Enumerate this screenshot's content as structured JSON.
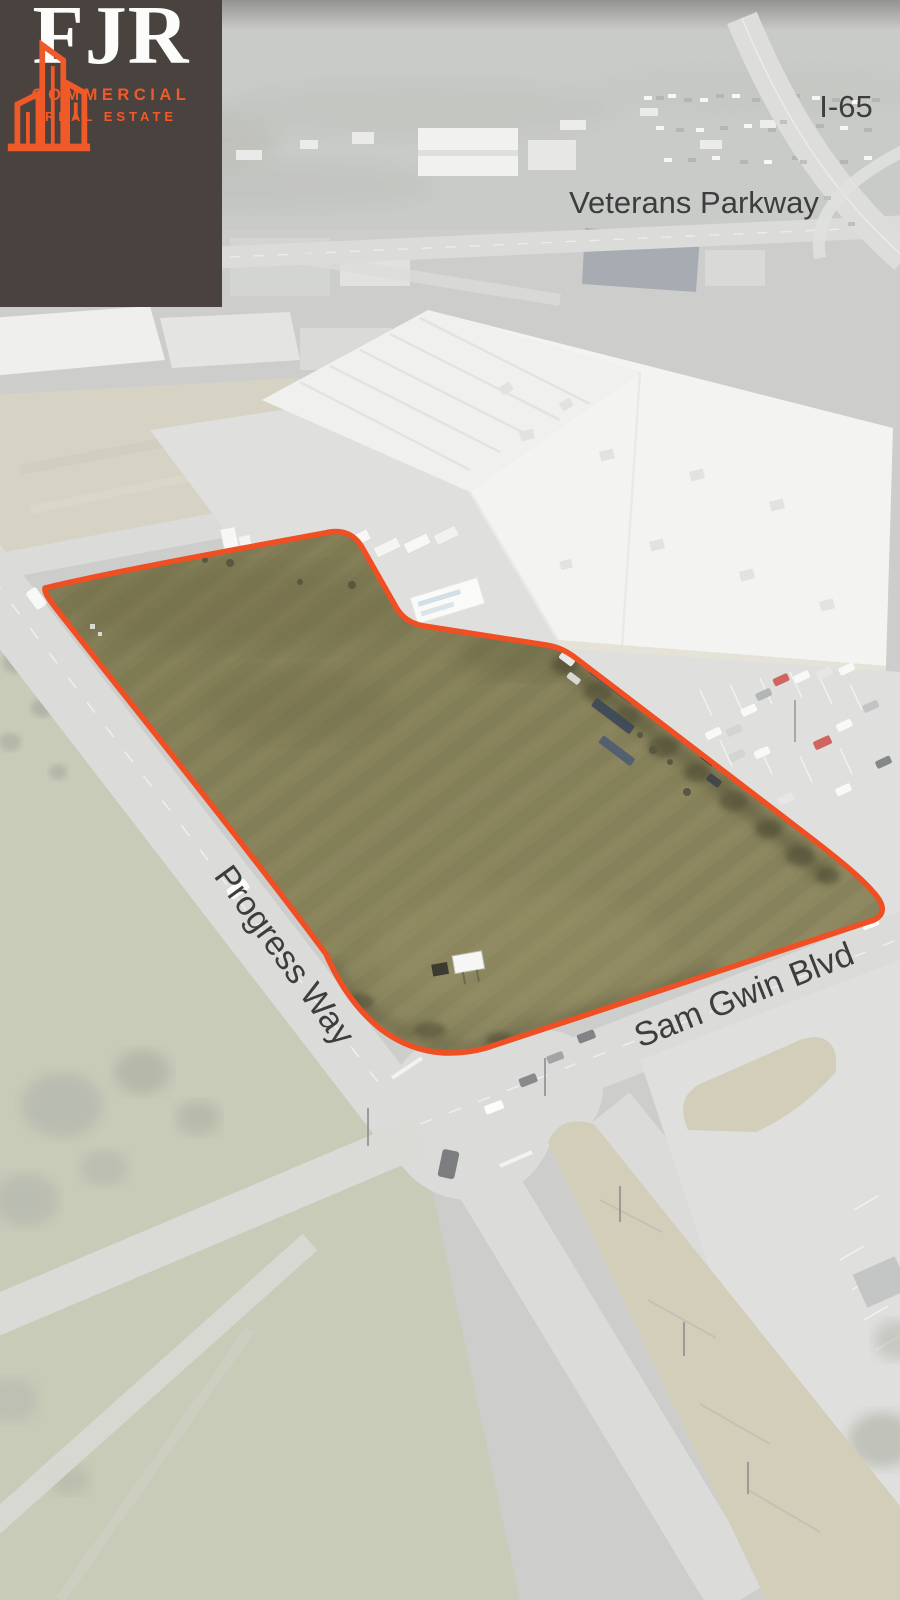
{
  "brand": {
    "name": "FJR",
    "tagline_line1": "COMMERCIAL",
    "tagline_line2": "REAL ESTATE",
    "logo_background": "#49423E",
    "logo_accent": "#F05A28"
  },
  "map_labels": {
    "highway": "I-65",
    "parkway": "Veterans Parkway",
    "street_west": "Progress Way",
    "street_south": "Sam Gwin Blvd",
    "label_color": "#3D3D3D"
  },
  "parcel": {
    "outline_color": "#F04E23",
    "description": "vacant land parcel highlighted in full color on washed aerial photo"
  }
}
